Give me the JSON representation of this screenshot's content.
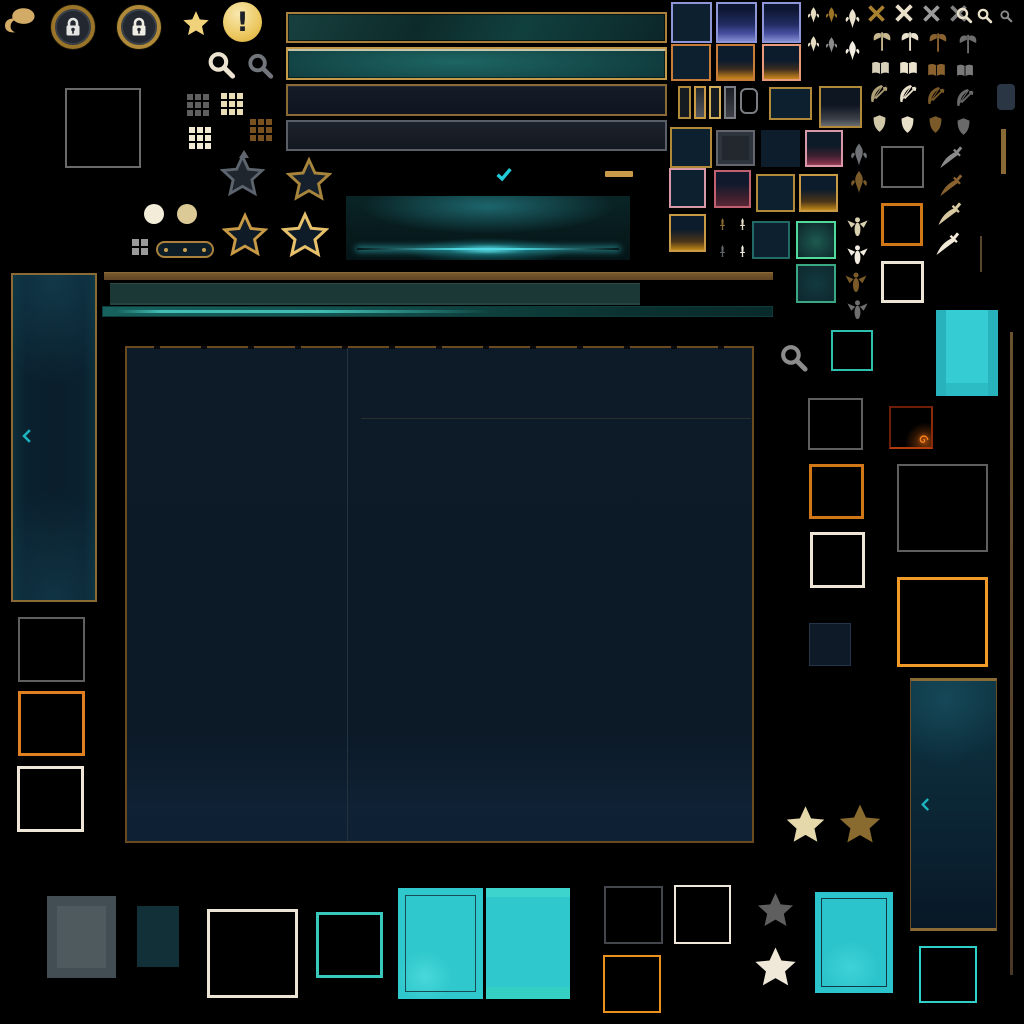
{
  "meta": {
    "description": "Game client UI texture atlas on black background (no visible text labels)",
    "background": "#000000",
    "canvas": {
      "width": 1024,
      "height": 1024
    }
  },
  "glyphs": {
    "exclamation": "!"
  },
  "palette": {
    "goldBorder": "#a9813c",
    "goldLight": "#c29a4a",
    "goldBright": "#f0d27a",
    "goldPale": "#e5d9ac",
    "bronze": "#8a6a35",
    "brown": "#6b4d26",
    "brownDark": "#54432c",
    "cream": "#e9e0cb",
    "white": "#f2ede0",
    "tan": "#c8b890",
    "gray": "#6e6e6e",
    "grayLight": "#9a9a9a",
    "grayMid": "#55595f",
    "grayFrame": "#5f5f5f",
    "navy": "#0d1b29",
    "periwinkle": "#8e96d8",
    "orange": "#d07818",
    "orangeBright": "#f09a28",
    "salmon": "#e89a7a",
    "pink": "#d898a8",
    "pinkDark": "#c06070",
    "tealBorder": "#226a66",
    "mint": "#52d89a",
    "mintDark": "#3aa882",
    "cyan": "#2fc8cc",
    "cyanBright": "#21ccd8",
    "tealFrame": "#2fbfae",
    "fireGlow": "#ff8a20"
  },
  "icons": {
    "hat-blob": "gold paint-blob / beret",
    "lock": "padlock in gold ring badge",
    "star": "five-point star",
    "alert": "exclamation badge",
    "magnifier": "search magnifying glass",
    "grid-dots": "3x3 dot grid",
    "x": "close cross",
    "axe": "double-bladed axe rank icon",
    "book": "open book rank icon",
    "bow": "bow and arrow rank icon",
    "shield": "kite shield rank icon",
    "sword": "small upright sword",
    "knife": "curved dagger",
    "bee": "winged sprite ornament",
    "fleur": "leaf/flame filigree ornament",
    "check": "checkmark",
    "chevron-left": "collapse arrow",
    "spiral": "flame spiral corner ember"
  },
  "atlas_groups": {
    "top_left": [
      "hat-blob",
      "lock-badge",
      "lock-badge-bright",
      "gold-star-filled",
      "alert-badge",
      "magnifier-cream",
      "magnifier-gray",
      "frame-square-gray",
      "grid-dots-gray",
      "grid-dots-cream",
      "grid-dots-cream-2",
      "grid-dots-brown"
    ],
    "top_bars": [
      "bar-teal-gold",
      "bar-teal-bright-gold",
      "bar-navy-gold",
      "bar-navy-gray"
    ],
    "slot_tiles": [
      "tile-blue-plain",
      "tile-blue-gradient",
      "tile-blue-gradient-2",
      "tile-orange-plain",
      "tile-orange-gradient",
      "tile-salmon-gradient",
      "slider-handles",
      "tile-gold-plain",
      "tile-gold-gray-gradient",
      "tile-gray",
      "tile-navy-plain",
      "tile-pink-gradient",
      "tile-pink-plain",
      "tile-maroon-gradient",
      "tile-gold-gradient",
      "tile-teal-dark",
      "tile-teal-glow"
    ],
    "rank_icon_rows": [
      "x-gold",
      "x-cream",
      "x-gray-1",
      "x-gray-2",
      "magnifier-small-cream-1",
      "magnifier-small-cream-2",
      "magnifier-small-gray",
      "axe-tan",
      "axe-cream",
      "axe-brown",
      "axe-gray",
      "book-pale",
      "book-cream",
      "book-brown",
      "book-gray",
      "bow-tan",
      "bow-cream",
      "bow-brown",
      "bow-gray",
      "shield-pale",
      "shield-cream",
      "shield-brown",
      "shield-gray"
    ],
    "ornaments": [
      "fleur-cream-1",
      "fleur-gold",
      "fleur-cream-large",
      "fleur-cream-2",
      "fleur-gray",
      "fleur-white-large",
      "leaf-gray",
      "leaf-brown",
      "bee-cream",
      "bee-white",
      "bee-brown",
      "bee-gray",
      "sword-brown",
      "sword-cream",
      "sword-gray",
      "sword-white",
      "knife-gray",
      "knife-brown",
      "knife-cream",
      "knife-white"
    ],
    "stars": [
      "star-outline-gray",
      "star-outline-gold-1",
      "star-outline-gold-2",
      "star-outline-gold-bright",
      "star-cream-large",
      "star-brown-large",
      "star-gray-filled",
      "star-white-filled"
    ],
    "panels": [
      "left-collapse-panel",
      "right-collapse-panel",
      "main-content-panel",
      "glow-button"
    ],
    "bars_mid": [
      "divider-brown",
      "bar-dark-teal",
      "bar-teal-gradient"
    ],
    "frames": [
      "frame-gray",
      "frame-orange",
      "frame-white",
      "frame-fire-ember",
      "frame-gray-large",
      "frame-orange-large",
      "frame-teal",
      "frame-cyan-bottom-right"
    ],
    "placeholders": [
      "cyan-tile-right",
      "cyan-tile-1",
      "cyan-tile-2",
      "cyan-tile-3",
      "gray-filled-rect",
      "teal-filled-rect",
      "navy-filled-tile"
    ],
    "misc": [
      "checkmark-cyan",
      "gold-dash",
      "circle-cream",
      "circle-tan",
      "pill-handle",
      "mini-grid",
      "triangle-gray",
      "rounded-dark-rect",
      "gold-vline",
      "brown-vline-short",
      "brown-vline-long"
    ]
  }
}
